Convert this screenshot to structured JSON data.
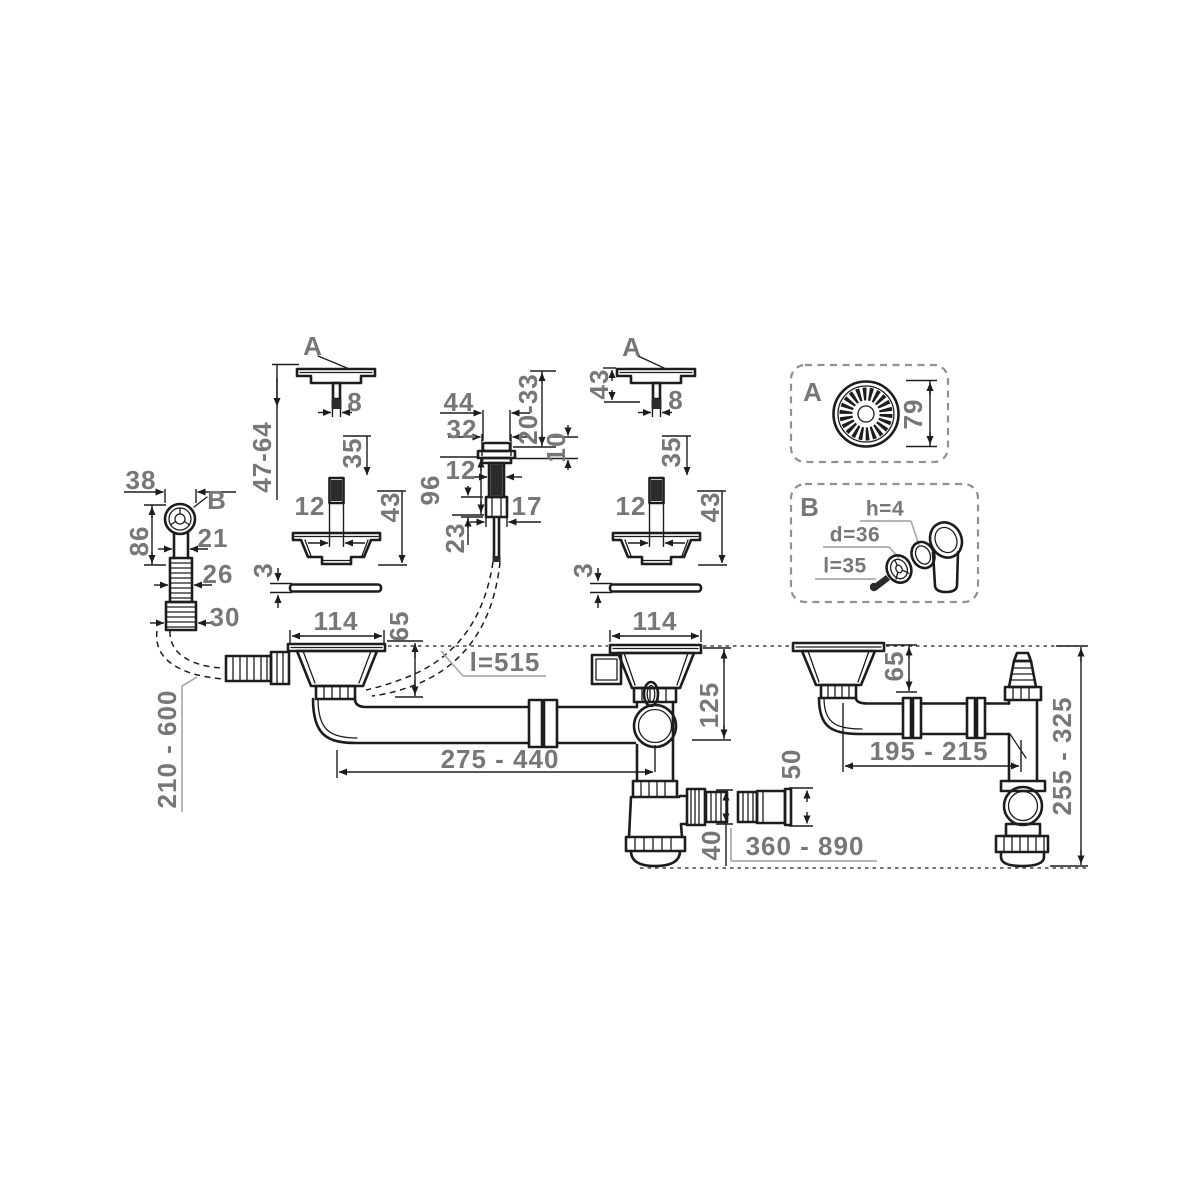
{
  "page": {
    "background": "#ffffff",
    "line_color": "#1d1d1b",
    "label_color": "#75777a",
    "detail_box_border": "#8f9193",
    "description": "technical-dimension-drawing"
  },
  "labels": {
    "a_left": "A",
    "dim8_left": "8",
    "dim47_64": "47-64",
    "dim35_left": "35",
    "dim12_left": "12",
    "dim43_left": "43",
    "dim3_left": "3",
    "dim114_left": "114",
    "dim65_left": "65",
    "dim44": "44",
    "dim32": "32",
    "dim20_33": "20-33",
    "dim10": "10",
    "dim96": "96",
    "dim12_mid": "12",
    "dim17": "17",
    "dim23": "23",
    "cable_len": "l=515",
    "dim43_rt": "43",
    "a_right": "A",
    "dim8_right": "8",
    "dim35_right": "35",
    "dim12_right": "12",
    "dim43_right": "43",
    "dim3_right": "3",
    "dim114_center": "114",
    "dim38": "38",
    "b_left": "B",
    "dim21": "21",
    "dim86": "86",
    "dim26": "26",
    "dim30": "30",
    "hose_range": "210 - 600",
    "dim125": "125",
    "span_range": "275 - 440",
    "dim40": "40",
    "dim50": "50",
    "outlet_range": "360 - 890",
    "dim65_right": "65",
    "dim195_215": "195 - 215",
    "dim255_325": "255 - 325",
    "a_detail": "A",
    "dim79": "79",
    "b_detail": "B",
    "dim_h": "h=4",
    "dim_d": "d=36",
    "dim_l": "l=35"
  }
}
